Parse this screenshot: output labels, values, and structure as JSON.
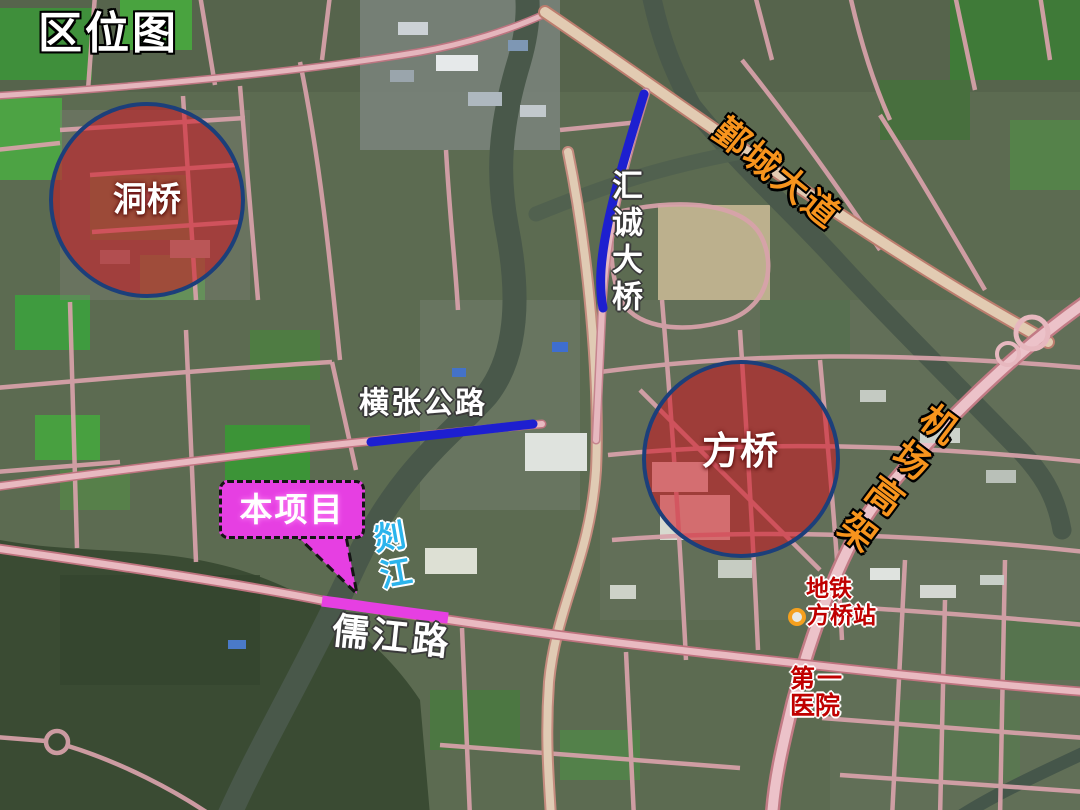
{
  "title": "区位图",
  "legend_colors": {
    "region_fill": "rgba(207,20,32,0.55)",
    "region_border": "#1c3f7a",
    "bridge_highlight_blue": "#1d1fd0",
    "project_magenta": "#e63fe2",
    "road_label_orange": "#f7941d",
    "river_label_blue": "#2bb4ec",
    "poi_red": "#c00000",
    "metro_ring_orange": "#f5a01e"
  },
  "regions": {
    "dongqiao": {
      "label": "洞桥"
    },
    "fangqiao": {
      "label": "方桥"
    }
  },
  "roads": {
    "yincheng_avenue": {
      "label": "鄞城大道"
    },
    "airport_elevated": {
      "label": "机场高架"
    },
    "huicheng_bridge": {
      "label": "汇诚大桥"
    },
    "hengzhang_highway": {
      "label": "横张公路"
    },
    "rujiang_road": {
      "label": "儒江路"
    },
    "shan_river": {
      "label": "剡江"
    }
  },
  "project": {
    "label": "本项目"
  },
  "pois": {
    "metro_station": {
      "line1": "地铁",
      "line2": "方桥站"
    },
    "hospital": {
      "line1": "第一",
      "line2": "医院"
    }
  }
}
